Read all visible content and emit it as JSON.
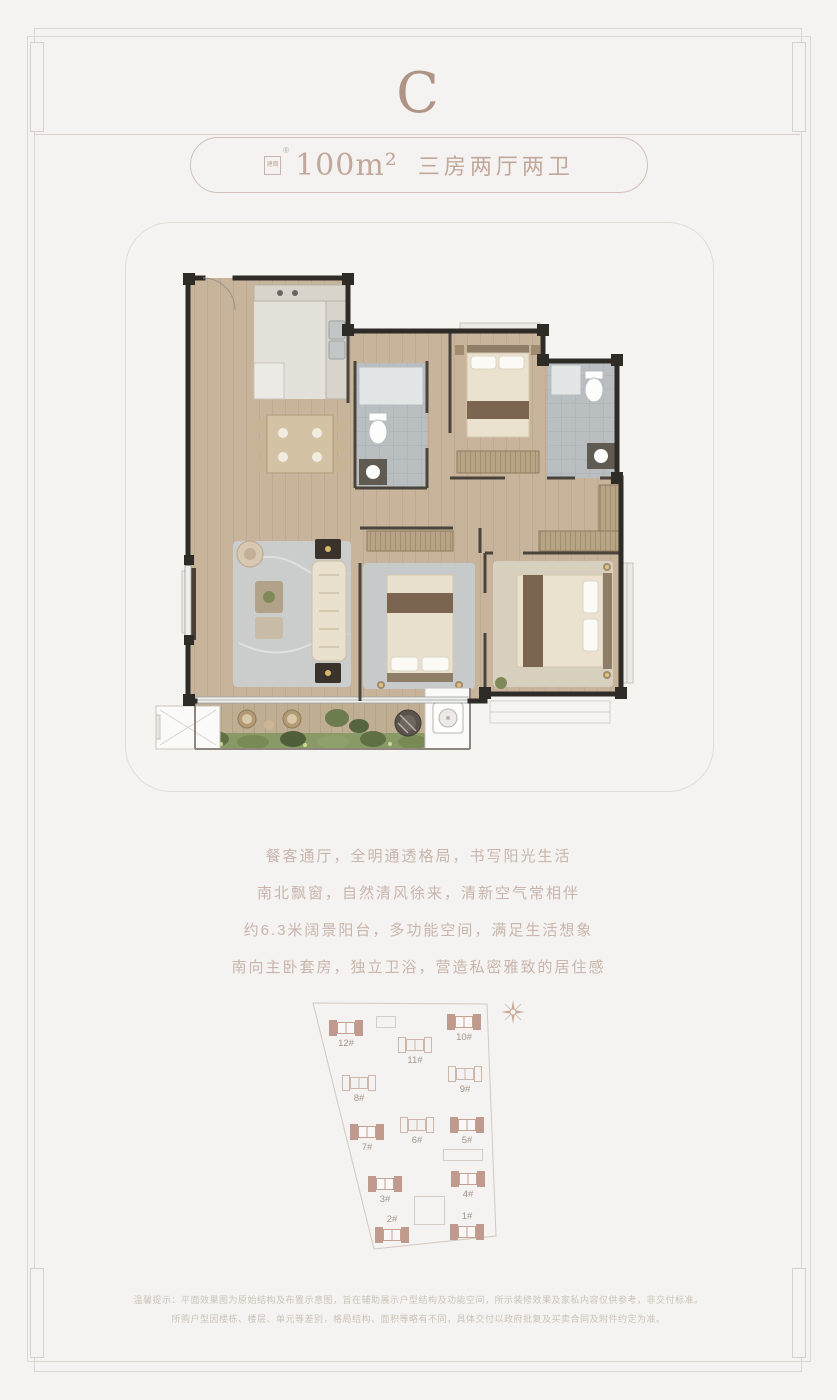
{
  "page": {
    "unit_letter": "C",
    "background_color": "#f4f3f1",
    "accent_color": "#c2a89c",
    "highlight_building_color": "#c09a8c"
  },
  "header": {
    "area_badge": "建面",
    "registered_mark": "®",
    "area_value": "100m²",
    "layout_text": "三房两厅两卫"
  },
  "features": [
    "餐客通厅，全明通透格局，书写阳光生活",
    "南北飘窗，自然清风徐来，清新空气常相伴",
    "约6.3米阔景阳台，多功能空间，满足生活想象",
    "南向主卧套房，独立卫浴，营造私密雅致的居住感"
  ],
  "site_plan": {
    "compass": "compass-rose-icon",
    "buildings": [
      {
        "label": "1#",
        "highlighted": true
      },
      {
        "label": "2#",
        "highlighted": true
      },
      {
        "label": "3#",
        "highlighted": true
      },
      {
        "label": "4#",
        "highlighted": true
      },
      {
        "label": "5#",
        "highlighted": true
      },
      {
        "label": "6#",
        "highlighted": false
      },
      {
        "label": "7#",
        "highlighted": true
      },
      {
        "label": "8#",
        "highlighted": false
      },
      {
        "label": "9#",
        "highlighted": false
      },
      {
        "label": "10#",
        "highlighted": true
      },
      {
        "label": "11#",
        "highlighted": false
      },
      {
        "label": "12#",
        "highlighted": true
      }
    ]
  },
  "disclaimer": {
    "line1": "温馨提示：平面效果图为原始结构及布置示意图，旨在辅助展示户型结构及功能空间，所示装修效果及家私内容仅供参考，非交付标准。",
    "line2": "所购户型因楼栋、楼层、单元等差别，格局结构、面积等略有不同，具体交付以政府批复及买卖合同及附件约定为准。"
  }
}
